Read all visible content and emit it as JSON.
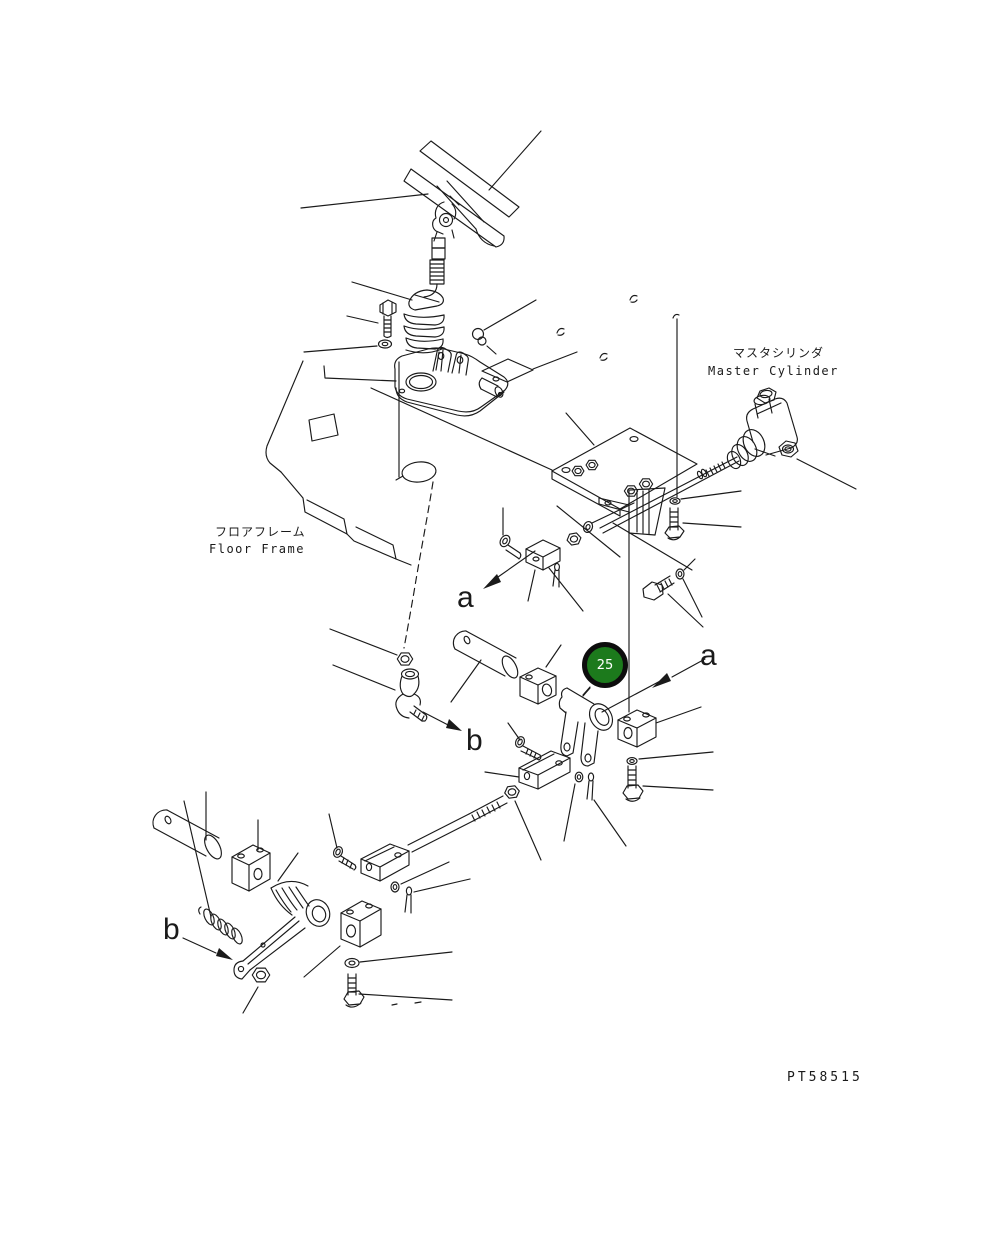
{
  "page": {
    "background": "#ffffff",
    "ink": "#1a1a1a",
    "type": "parts-exploded-diagram"
  },
  "annotations": {
    "master_cylinder": {
      "jp": "マスタシリンダ",
      "en": "Master Cylinder"
    },
    "floor_frame": {
      "jp": "フロアフレーム",
      "en": "Floor Frame"
    },
    "section_a": "a",
    "section_b": "b",
    "part_code": "PT58515",
    "callout_25": {
      "number": "25",
      "fill": "#1c7a1c",
      "ring": "#0d0d0d",
      "text_color": "#ffffff"
    }
  }
}
